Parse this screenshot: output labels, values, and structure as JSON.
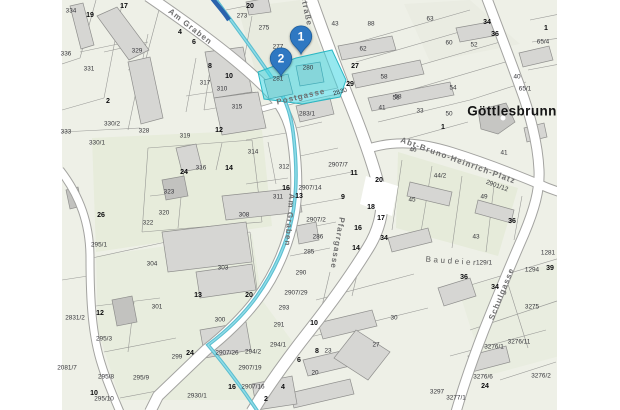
{
  "map": {
    "place_label": "Göttlesbrunn",
    "area_label": "Baudeier",
    "street_labels": [
      {
        "text": "Am Graben",
        "x": 190,
        "y": 27,
        "rot": 38
      },
      {
        "text": "straße",
        "x": 306,
        "y": 11,
        "rot": 78
      },
      {
        "text": "Postgasse",
        "x": 301,
        "y": 97,
        "rot": -13
      },
      {
        "text": "Am Graben",
        "x": 289,
        "y": 220,
        "rot": 95
      },
      {
        "text": "Pfarrgasse",
        "x": 337,
        "y": 243,
        "rot": 100
      },
      {
        "text": "Abt-Bruno-Heinrich-Platz",
        "x": 458,
        "y": 161,
        "rot": 20
      },
      {
        "text": "Schulgasse",
        "x": 502,
        "y": 294,
        "rot": -68
      }
    ],
    "markers": [
      {
        "label": "1",
        "x": 301,
        "y": 60
      },
      {
        "label": "2",
        "x": 281,
        "y": 82
      }
    ],
    "colors": {
      "marker": "#2e78c2",
      "marker_edge": "#1c5d9c",
      "highlight": "rgba(64,214,226,0.55)",
      "highlight_edge": "#2bb7c4",
      "stream": "#54bccd",
      "background": "#eef0e7",
      "building": "#d6d6d3",
      "road": "#ffffff"
    },
    "parcel_labels": [
      {
        "t": "334",
        "x": 71,
        "y": 11
      },
      {
        "t": "19",
        "x": 90,
        "y": 15,
        "b": 1
      },
      {
        "t": "17",
        "x": 124,
        "y": 6,
        "b": 1
      },
      {
        "t": "336",
        "x": 66,
        "y": 54
      },
      {
        "t": "331",
        "x": 89,
        "y": 69
      },
      {
        "t": "329",
        "x": 137,
        "y": 51
      },
      {
        "t": "2",
        "x": 108,
        "y": 101,
        "b": 1
      },
      {
        "t": "330/2",
        "x": 112,
        "y": 124
      },
      {
        "t": "328",
        "x": 144,
        "y": 131
      },
      {
        "t": "319",
        "x": 185,
        "y": 136
      },
      {
        "t": "12",
        "x": 219,
        "y": 130,
        "b": 1
      },
      {
        "t": "317",
        "x": 205,
        "y": 83
      },
      {
        "t": "310",
        "x": 222,
        "y": 89
      },
      {
        "t": "315",
        "x": 237,
        "y": 107
      },
      {
        "t": "4",
        "x": 180,
        "y": 32,
        "b": 1
      },
      {
        "t": "6",
        "x": 194,
        "y": 42,
        "b": 1
      },
      {
        "t": "8",
        "x": 210,
        "y": 66,
        "b": 1
      },
      {
        "t": "10",
        "x": 229,
        "y": 76,
        "b": 1
      },
      {
        "t": "20",
        "x": 250,
        "y": 6,
        "b": 1
      },
      {
        "t": "273",
        "x": 242,
        "y": 16
      },
      {
        "t": "275",
        "x": 264,
        "y": 28
      },
      {
        "t": "277",
        "x": 278,
        "y": 47
      },
      {
        "t": "280",
        "x": 308,
        "y": 68
      },
      {
        "t": "281",
        "x": 278,
        "y": 79
      },
      {
        "t": "283/1",
        "x": 307,
        "y": 114
      },
      {
        "t": "2830",
        "x": 340,
        "y": 92,
        "r": -16
      },
      {
        "t": "43",
        "x": 335,
        "y": 24
      },
      {
        "t": "88",
        "x": 371,
        "y": 24
      },
      {
        "t": "62",
        "x": 363,
        "y": 49
      },
      {
        "t": "27",
        "x": 355,
        "y": 66,
        "b": 1
      },
      {
        "t": "58",
        "x": 384,
        "y": 77
      },
      {
        "t": "29",
        "x": 350,
        "y": 84,
        "b": 1
      },
      {
        "t": "56",
        "x": 396,
        "y": 98
      },
      {
        "t": "41",
        "x": 382,
        "y": 108
      },
      {
        "t": "33",
        "x": 420,
        "y": 111
      },
      {
        "t": "63",
        "x": 430,
        "y": 19
      },
      {
        "t": "34",
        "x": 487,
        "y": 22,
        "b": 1
      },
      {
        "t": "36",
        "x": 495,
        "y": 34,
        "b": 1
      },
      {
        "t": "60",
        "x": 449,
        "y": 43
      },
      {
        "t": "52",
        "x": 474,
        "y": 45
      },
      {
        "t": "1",
        "x": 546,
        "y": 28,
        "b": 1
      },
      {
        "t": "65/4",
        "x": 543,
        "y": 42
      },
      {
        "t": "54",
        "x": 453,
        "y": 88
      },
      {
        "t": "58",
        "x": 398,
        "y": 97
      },
      {
        "t": "40",
        "x": 517,
        "y": 77
      },
      {
        "t": "65/1",
        "x": 525,
        "y": 89
      },
      {
        "t": "50",
        "x": 449,
        "y": 114
      },
      {
        "t": "1",
        "x": 443,
        "y": 127,
        "b": 1
      },
      {
        "t": "46",
        "x": 413,
        "y": 150
      },
      {
        "t": "44/2",
        "x": 440,
        "y": 176
      },
      {
        "t": "41",
        "x": 504,
        "y": 153
      },
      {
        "t": "2901/12",
        "x": 497,
        "y": 186,
        "r": 20
      },
      {
        "t": "49",
        "x": 484,
        "y": 197
      },
      {
        "t": "45",
        "x": 412,
        "y": 200
      },
      {
        "t": "36",
        "x": 512,
        "y": 221,
        "b": 1
      },
      {
        "t": "43",
        "x": 476,
        "y": 237
      },
      {
        "t": "129/1",
        "x": 484,
        "y": 263
      },
      {
        "t": "1281",
        "x": 548,
        "y": 253
      },
      {
        "t": "39",
        "x": 550,
        "y": 268,
        "b": 1
      },
      {
        "t": "1294",
        "x": 532,
        "y": 270
      },
      {
        "t": "3275",
        "x": 532,
        "y": 307
      },
      {
        "t": "34",
        "x": 495,
        "y": 287,
        "b": 1
      },
      {
        "t": "36",
        "x": 464,
        "y": 277,
        "b": 1
      },
      {
        "t": "3276/11",
        "x": 519,
        "y": 342
      },
      {
        "t": "3276/1",
        "x": 494,
        "y": 347
      },
      {
        "t": "3276/6",
        "x": 483,
        "y": 377
      },
      {
        "t": "24",
        "x": 485,
        "y": 386,
        "b": 1
      },
      {
        "t": "3276/2",
        "x": 541,
        "y": 376
      },
      {
        "t": "3277/1",
        "x": 456,
        "y": 398
      },
      {
        "t": "3297",
        "x": 437,
        "y": 392
      },
      {
        "t": "314",
        "x": 253,
        "y": 152
      },
      {
        "t": "312",
        "x": 284,
        "y": 167
      },
      {
        "t": "2907/7",
        "x": 338,
        "y": 165
      },
      {
        "t": "11",
        "x": 354,
        "y": 173,
        "b": 1
      },
      {
        "t": "20",
        "x": 379,
        "y": 180,
        "b": 1
      },
      {
        "t": "16",
        "x": 286,
        "y": 188,
        "b": 1
      },
      {
        "t": "2907/14",
        "x": 310,
        "y": 188
      },
      {
        "t": "311",
        "x": 278,
        "y": 197
      },
      {
        "t": "13",
        "x": 299,
        "y": 196,
        "b": 1
      },
      {
        "t": "9",
        "x": 343,
        "y": 197,
        "b": 1
      },
      {
        "t": "308",
        "x": 244,
        "y": 215
      },
      {
        "t": "18",
        "x": 371,
        "y": 207,
        "b": 1
      },
      {
        "t": "17",
        "x": 381,
        "y": 218,
        "b": 1
      },
      {
        "t": "2907/2",
        "x": 316,
        "y": 220
      },
      {
        "t": "16",
        "x": 358,
        "y": 228,
        "b": 1
      },
      {
        "t": "286",
        "x": 318,
        "y": 237
      },
      {
        "t": "34",
        "x": 384,
        "y": 238,
        "b": 1
      },
      {
        "t": "285",
        "x": 309,
        "y": 252
      },
      {
        "t": "14",
        "x": 356,
        "y": 248,
        "b": 1
      },
      {
        "t": "333",
        "x": 66,
        "y": 132
      },
      {
        "t": "330/1",
        "x": 97,
        "y": 143
      },
      {
        "t": "24",
        "x": 184,
        "y": 172,
        "b": 1
      },
      {
        "t": "316",
        "x": 201,
        "y": 168
      },
      {
        "t": "14",
        "x": 229,
        "y": 168,
        "b": 1
      },
      {
        "t": "323",
        "x": 169,
        "y": 192
      },
      {
        "t": "320",
        "x": 164,
        "y": 213
      },
      {
        "t": "322",
        "x": 148,
        "y": 223
      },
      {
        "t": "26",
        "x": 101,
        "y": 215,
        "b": 1
      },
      {
        "t": "295/1",
        "x": 99,
        "y": 245
      },
      {
        "t": "2831/2",
        "x": 75,
        "y": 318
      },
      {
        "t": "12",
        "x": 100,
        "y": 313,
        "b": 1
      },
      {
        "t": "304",
        "x": 152,
        "y": 264
      },
      {
        "t": "303",
        "x": 223,
        "y": 268
      },
      {
        "t": "301",
        "x": 157,
        "y": 307
      },
      {
        "t": "300",
        "x": 220,
        "y": 320
      },
      {
        "t": "13",
        "x": 198,
        "y": 295,
        "b": 1
      },
      {
        "t": "295/3",
        "x": 104,
        "y": 339
      },
      {
        "t": "299",
        "x": 177,
        "y": 357
      },
      {
        "t": "24",
        "x": 190,
        "y": 353,
        "b": 1
      },
      {
        "t": "295/8",
        "x": 106,
        "y": 377
      },
      {
        "t": "295/9",
        "x": 141,
        "y": 378
      },
      {
        "t": "10",
        "x": 94,
        "y": 393,
        "b": 1
      },
      {
        "t": "295/10",
        "x": 104,
        "y": 399
      },
      {
        "t": "2081/7",
        "x": 67,
        "y": 368
      },
      {
        "t": "290",
        "x": 301,
        "y": 273
      },
      {
        "t": "20",
        "x": 249,
        "y": 295,
        "b": 1
      },
      {
        "t": "2907/29",
        "x": 296,
        "y": 293
      },
      {
        "t": "293",
        "x": 284,
        "y": 308
      },
      {
        "t": "291",
        "x": 279,
        "y": 325
      },
      {
        "t": "10",
        "x": 314,
        "y": 323,
        "b": 1
      },
      {
        "t": "294/1",
        "x": 278,
        "y": 345
      },
      {
        "t": "294/2",
        "x": 253,
        "y": 352
      },
      {
        "t": "2907/26",
        "x": 227,
        "y": 353
      },
      {
        "t": "2907/19",
        "x": 250,
        "y": 368
      },
      {
        "t": "16",
        "x": 232,
        "y": 387,
        "b": 1
      },
      {
        "t": "2907/16",
        "x": 253,
        "y": 387
      },
      {
        "t": "2930/1",
        "x": 197,
        "y": 396
      },
      {
        "t": "8",
        "x": 317,
        "y": 351,
        "b": 1
      },
      {
        "t": "23",
        "x": 328,
        "y": 351
      },
      {
        "t": "20",
        "x": 315,
        "y": 373
      },
      {
        "t": "27",
        "x": 376,
        "y": 345
      },
      {
        "t": "30",
        "x": 394,
        "y": 318
      },
      {
        "t": "6",
        "x": 299,
        "y": 360,
        "b": 1
      },
      {
        "t": "4",
        "x": 283,
        "y": 387,
        "b": 1
      },
      {
        "t": "2",
        "x": 266,
        "y": 399,
        "b": 1
      }
    ]
  }
}
